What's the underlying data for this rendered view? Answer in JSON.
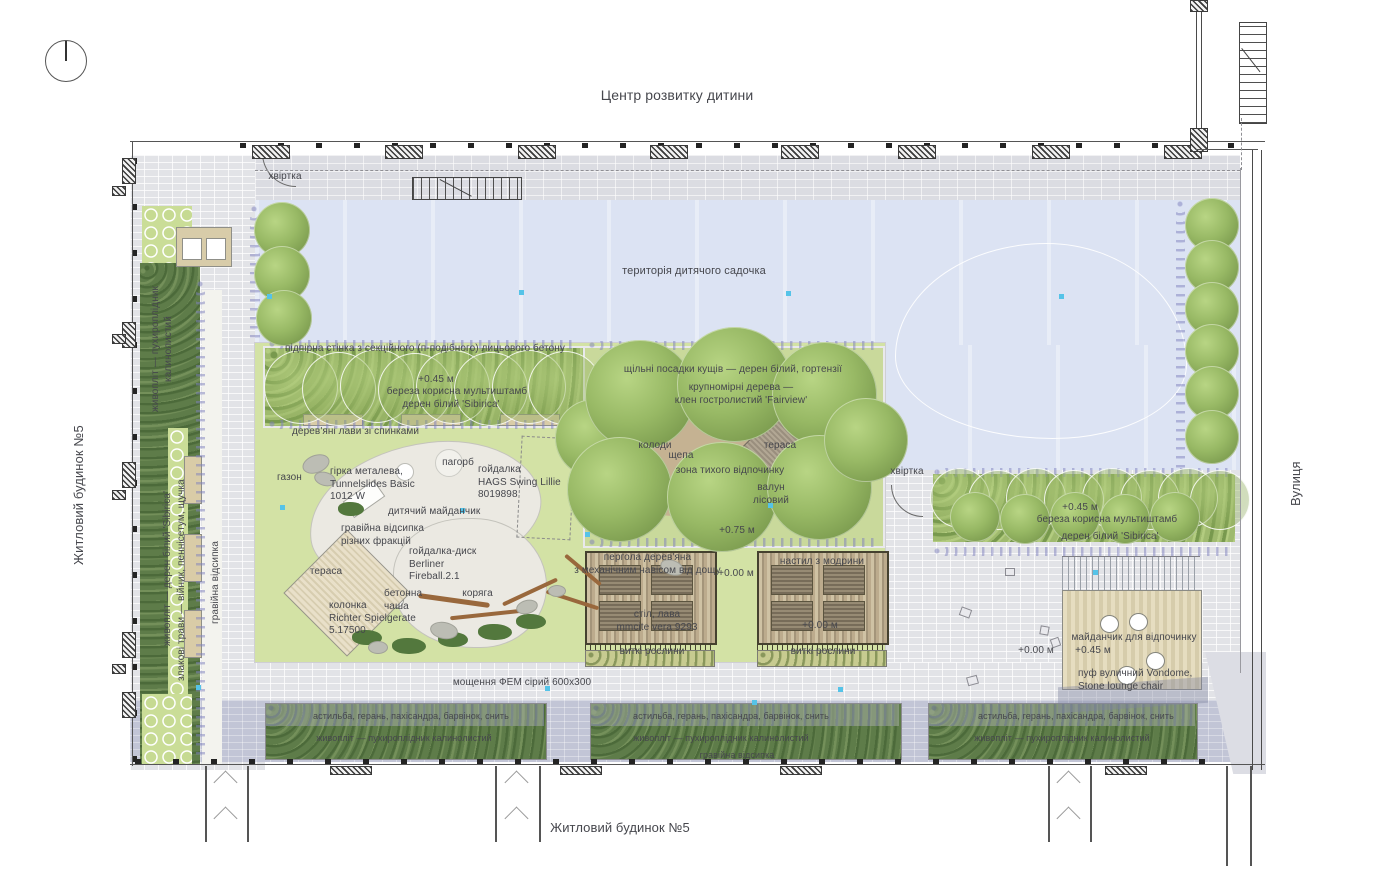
{
  "surroundings": {
    "top_building": "Центр розвитку дитини",
    "left_building": "Житловий будинок №5",
    "bottom_building": "Житловий будинок №5",
    "street": "Вулиця"
  },
  "site": {
    "kindergarten_area": "територія дитячого садочка",
    "gate": "хвіртка",
    "retaining_wall": "підпірна стінка з секційного (п-подібного) лицьового бетону",
    "benches_row": "дерев'яні лави зі спинками",
    "lawn": "газон",
    "paving": "мощення ФЕМ сірий 600х300"
  },
  "elevations": {
    "e000": "+0.00 м",
    "e045": "+0.45 м",
    "e075": "+0.75 м"
  },
  "planting": {
    "birch": "береза корисна мультиштамб",
    "dogwood": "дерен білий 'Sibirica'",
    "hedge_physocarpus_vert": "живопліт — пухироплідник\nкалинолистий",
    "hedge_dogwood_vert": "живопліт — дерен білий 'Sibirica'",
    "grasses_vert": "злакові трави — війник, пеннісетум, щучка",
    "gravel_bed": "гравійна відсипка",
    "shrubs_dense": "щільні посадки кущів — дерен білий, гортензії",
    "large_trees": "крупномірні дерева —\nклен гостролистий 'Fairview'",
    "groundcover": "астильба, герань, пахісандра, барвінок, снить",
    "hedge_physocarpus": "живопліт — пухироплідник калинолистий",
    "climbing_plants": "виткі рослини"
  },
  "playground": {
    "area": "дитячий майданчик",
    "gravel_fractions": "гравійна відсипка\nрізних фракцій",
    "slide": "гірка металева,\nTunnelslides Basic\n1012 W",
    "hill": "пагорб",
    "swing": "гойдалка\nHAGS Swing Lillie\n8019898",
    "disc_swing": "гойдалка-диск\nBerliner\nFireball.2.1",
    "concrete_bowl": "бетонна\nчаша",
    "snag": "коряга",
    "column": "колонка\nRichter Spielgerate\n5.17500",
    "terrace": "тераса"
  },
  "quiet_zone": {
    "zone": "зона тихого відпочинку",
    "logs": "колоди",
    "wood_chips": "щепа",
    "boulder": "валун\nлісовий"
  },
  "pergola": {
    "name": "пергола дерев'яна\nз механічним навісом від дощу",
    "table_bench": "стіл, лава\nmmcite vera 9293",
    "larch_deck": "настил з модрини"
  },
  "rest_area": {
    "name": "майданчик для відпочинку",
    "pouf": "пуф вуличний Vondome,\nStone lounge chair"
  },
  "colors": {
    "lawn": "#d3e2a5",
    "kindergarten": "#dce3f3",
    "paving": "#e2e3e7",
    "paving_dark": "#c2c5d6",
    "hedge": "#5e7c49",
    "tree": "#8fb058",
    "wood": "#cbbd9f",
    "marker": "#55c3e8"
  }
}
